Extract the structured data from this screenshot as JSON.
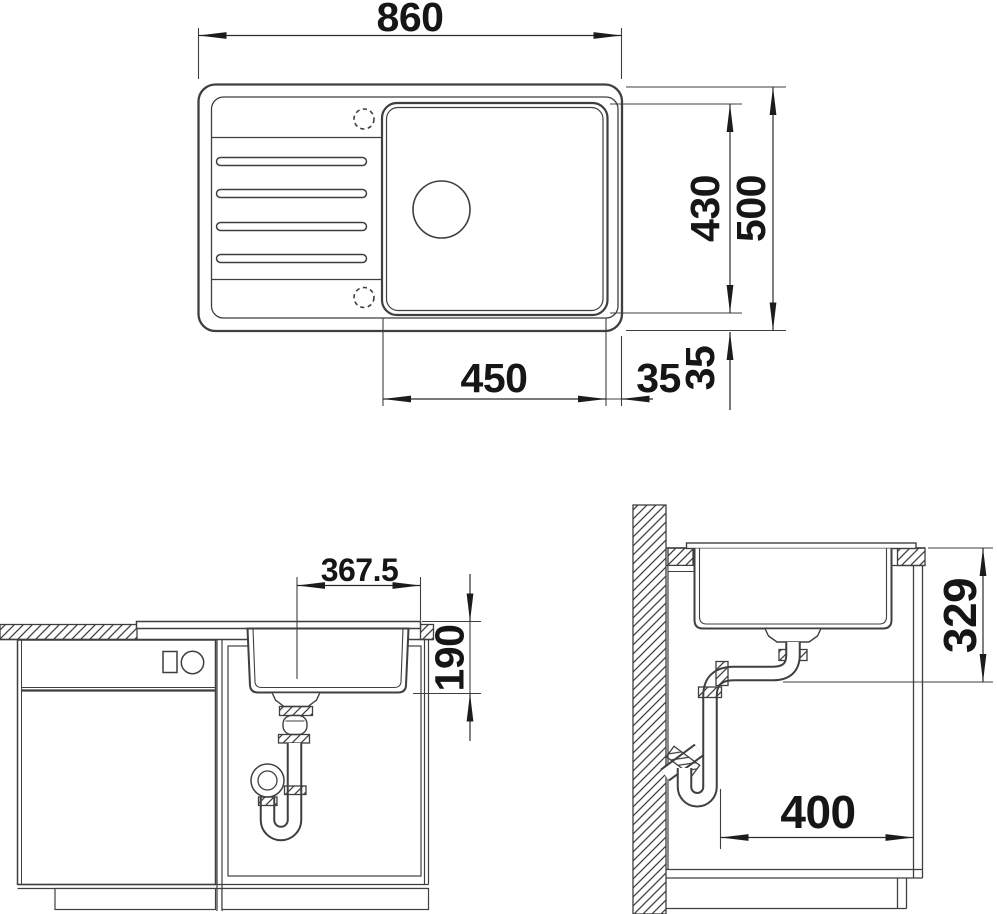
{
  "drawing": {
    "background": "#ffffff",
    "line_color": "#3f3f3f",
    "text_color": "#161616",
    "top_view": {
      "overall_width": "860",
      "overall_depth": "500",
      "bowl_depth": "430",
      "bowl_width": "450",
      "bowl_offset_right": "35",
      "bowl_offset_bottom": "35"
    },
    "front_view": {
      "drain_center_to_right_edge": "367.5",
      "bowl_inner_depth": "190"
    },
    "side_view": {
      "mounting_depth": "329",
      "base_clearance": "400"
    }
  }
}
